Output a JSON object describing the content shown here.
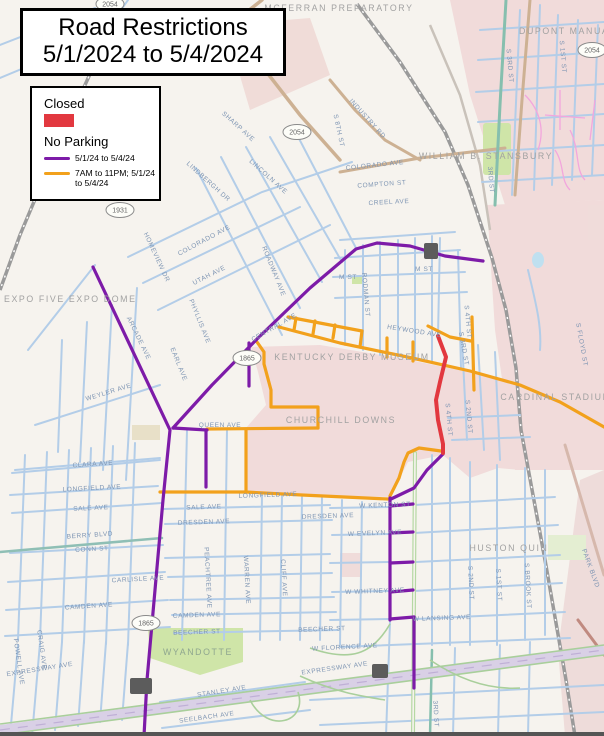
{
  "title": {
    "line1": "Road Restrictions",
    "line2": "5/1/2024 to 5/4/2024"
  },
  "legend": {
    "closed_label": "Closed",
    "closed_color": "#e2383f",
    "no_parking_label": "No Parking",
    "items": [
      {
        "label": "5/1/24 to 5/4/24",
        "color": "#7d1ba8"
      },
      {
        "label": "7AM to 11PM; 5/1/24 to 5/4/24",
        "color": "#f2a11c"
      }
    ]
  },
  "map": {
    "colors": {
      "closed": "#e2383f",
      "no_parking_event": "#7d1ba8",
      "no_parking_timed": "#f2a11c",
      "street": "#b3cde8",
      "background": "#f6f3ee",
      "campus_pink": "#f1dbda",
      "park_green": "#cfe5a8"
    },
    "poi_labels": [
      {
        "t": "MCFERRAN PREPARATORY",
        "x": 339,
        "y": 11
      },
      {
        "t": "DUPONT MANUAL H",
        "x": 519,
        "y": 34,
        "a": "start"
      },
      {
        "t": "WILLIAM B. STANSBURY",
        "x": 486,
        "y": 159
      },
      {
        "t": "EXPO FIVE EXPO DOME",
        "x": 4,
        "y": 302,
        "a": "start"
      },
      {
        "t": "KENTUCKY DERBY MUSEUM",
        "x": 352,
        "y": 360
      },
      {
        "t": "CHURCHILL DOWNS",
        "x": 341,
        "y": 423
      },
      {
        "t": "CARDINAL STADIUM",
        "x": 556,
        "y": 400
      },
      {
        "t": "HUSTON QUIN",
        "x": 509,
        "y": 551
      },
      {
        "t": "WYANDOTTE",
        "x": 198,
        "y": 655,
        "cls": "park-label"
      }
    ],
    "route_shields": [
      {
        "n": "2054",
        "x": 110,
        "y": 4
      },
      {
        "n": "2054",
        "x": 297,
        "y": 132
      },
      {
        "n": "2054",
        "x": 592,
        "y": 50
      },
      {
        "n": "1931",
        "x": 120,
        "y": 210
      },
      {
        "n": "1865",
        "x": 247,
        "y": 358
      },
      {
        "n": "1865",
        "x": 146,
        "y": 623
      }
    ],
    "street_labels": [
      {
        "t": "COLORADO AVE",
        "x": 375,
        "y": 167,
        "r": -6
      },
      {
        "t": "COMPTON ST",
        "x": 382,
        "y": 186,
        "r": -4
      },
      {
        "t": "CREEL AVE",
        "x": 389,
        "y": 204,
        "r": -3
      },
      {
        "t": "INDUSTRY RD",
        "x": 366,
        "y": 120,
        "r": 48
      },
      {
        "t": "S 8TH ST",
        "x": 337,
        "y": 131,
        "r": 78
      },
      {
        "t": "SHARP AVE",
        "x": 237,
        "y": 128,
        "r": 42
      },
      {
        "t": "LINDBERGH DR",
        "x": 207,
        "y": 183,
        "r": 42
      },
      {
        "t": "LINCOLN AVE",
        "x": 267,
        "y": 178,
        "r": 42
      },
      {
        "t": "HOMEVIEW DR",
        "x": 155,
        "y": 258,
        "r": 65
      },
      {
        "t": "COLORADO AVE",
        "x": 205,
        "y": 242,
        "r": -28
      },
      {
        "t": "UTAH AVE",
        "x": 210,
        "y": 277,
        "r": -27
      },
      {
        "t": "ROADWAY AVE",
        "x": 272,
        "y": 272,
        "r": 68
      },
      {
        "t": "M ST",
        "x": 348,
        "y": 279,
        "r": 0
      },
      {
        "t": "M ST",
        "x": 424,
        "y": 271,
        "r": 0
      },
      {
        "t": "RODMAN ST",
        "x": 364,
        "y": 295,
        "r": 85
      },
      {
        "t": "HEYWOOD AVE",
        "x": 414,
        "y": 333,
        "r": 9
      },
      {
        "t": "CENTRAL AVE",
        "x": 275,
        "y": 329,
        "r": -30
      },
      {
        "t": "ARCADE AVE",
        "x": 137,
        "y": 339,
        "r": 64
      },
      {
        "t": "PHYLLIS AVE",
        "x": 198,
        "y": 322,
        "r": 68
      },
      {
        "t": "EARL AVE",
        "x": 177,
        "y": 365,
        "r": 68
      },
      {
        "t": "WEYLER AVE",
        "x": 109,
        "y": 394,
        "r": -17
      },
      {
        "t": "QUEEN AVE",
        "x": 220,
        "y": 427,
        "r": 0
      },
      {
        "t": "CLARA AVE",
        "x": 93,
        "y": 466,
        "r": -4
      },
      {
        "t": "LONGFIELD AVE",
        "x": 92,
        "y": 490,
        "r": -3
      },
      {
        "t": "LONGFIELD AVE",
        "x": 268,
        "y": 497,
        "r": -2
      },
      {
        "t": "SALE AVE",
        "x": 91,
        "y": 510,
        "r": -3
      },
      {
        "t": "SALE AVE",
        "x": 204,
        "y": 509,
        "r": -2
      },
      {
        "t": "DRESDEN AVE",
        "x": 204,
        "y": 524,
        "r": -2
      },
      {
        "t": "DRESDEN AVE",
        "x": 328,
        "y": 518,
        "r": -2
      },
      {
        "t": "BERRY BLVD",
        "x": 90,
        "y": 537,
        "r": -4
      },
      {
        "t": "CONN ST",
        "x": 92,
        "y": 551,
        "r": -3
      },
      {
        "t": "CARLISLE AVE",
        "x": 138,
        "y": 581,
        "r": -3
      },
      {
        "t": "CAMDEN AVE",
        "x": 89,
        "y": 608,
        "r": -4
      },
      {
        "t": "CAMDEN AVE",
        "x": 197,
        "y": 617,
        "r": -2
      },
      {
        "t": "BEECHER ST",
        "x": 197,
        "y": 634,
        "r": -2
      },
      {
        "t": "BEECHER ST",
        "x": 322,
        "y": 631,
        "r": -2
      },
      {
        "t": "PEACHTREE AVE",
        "x": 206,
        "y": 578,
        "r": 87
      },
      {
        "t": "WARREN AVE",
        "x": 245,
        "y": 580,
        "r": 87
      },
      {
        "t": "CLIFF AVE",
        "x": 282,
        "y": 578,
        "r": 87
      },
      {
        "t": "W KENTON ST",
        "x": 385,
        "y": 507,
        "r": -2
      },
      {
        "t": "W EVELYN AVE",
        "x": 375,
        "y": 535,
        "r": -2
      },
      {
        "t": "W WHITNEY AVE",
        "x": 375,
        "y": 593,
        "r": -2
      },
      {
        "t": "W LANSING AVE",
        "x": 442,
        "y": 620,
        "r": -2
      },
      {
        "t": "W FLORENCE AVE",
        "x": 345,
        "y": 649,
        "r": -3
      },
      {
        "t": "EXPRESSWAY AVE",
        "x": 40,
        "y": 671,
        "r": -9
      },
      {
        "t": "EXPRESSWAY AVE",
        "x": 335,
        "y": 670,
        "r": -8
      },
      {
        "t": "STANLEY AVE",
        "x": 222,
        "y": 693,
        "r": -9
      },
      {
        "t": "SEELBACH AVE",
        "x": 207,
        "y": 719,
        "r": -8
      },
      {
        "t": "POWELL AVE",
        "x": 17,
        "y": 662,
        "r": 82
      },
      {
        "t": "CRAIG AVE",
        "x": 40,
        "y": 650,
        "r": 82
      },
      {
        "t": "S 2ND ST",
        "x": 469,
        "y": 583,
        "r": 87
      },
      {
        "t": "S 1ST ST",
        "x": 497,
        "y": 585,
        "r": 87
      },
      {
        "t": "S BROOK ST",
        "x": 526,
        "y": 586,
        "r": 87
      },
      {
        "t": "PARK BLVD",
        "x": 589,
        "y": 569,
        "r": 70
      },
      {
        "t": "S FLOYD ST",
        "x": 580,
        "y": 345,
        "r": 80
      },
      {
        "t": "S 3RD ST",
        "x": 508,
        "y": 66,
        "r": 85
      },
      {
        "t": "3RD ST",
        "x": 489,
        "y": 180,
        "r": 85
      },
      {
        "t": "S 3RD ST",
        "x": 462,
        "y": 349,
        "r": 80
      },
      {
        "t": "3RD ST",
        "x": 434,
        "y": 714,
        "r": 87
      },
      {
        "t": "S 1ST ST",
        "x": 561,
        "y": 57,
        "r": 85
      },
      {
        "t": "S 2ND ST",
        "x": 467,
        "y": 417,
        "r": 85
      },
      {
        "t": "S 4TH ST",
        "x": 466,
        "y": 322,
        "r": 85
      },
      {
        "t": "S 4TH ST",
        "x": 447,
        "y": 420,
        "r": 85
      }
    ]
  }
}
